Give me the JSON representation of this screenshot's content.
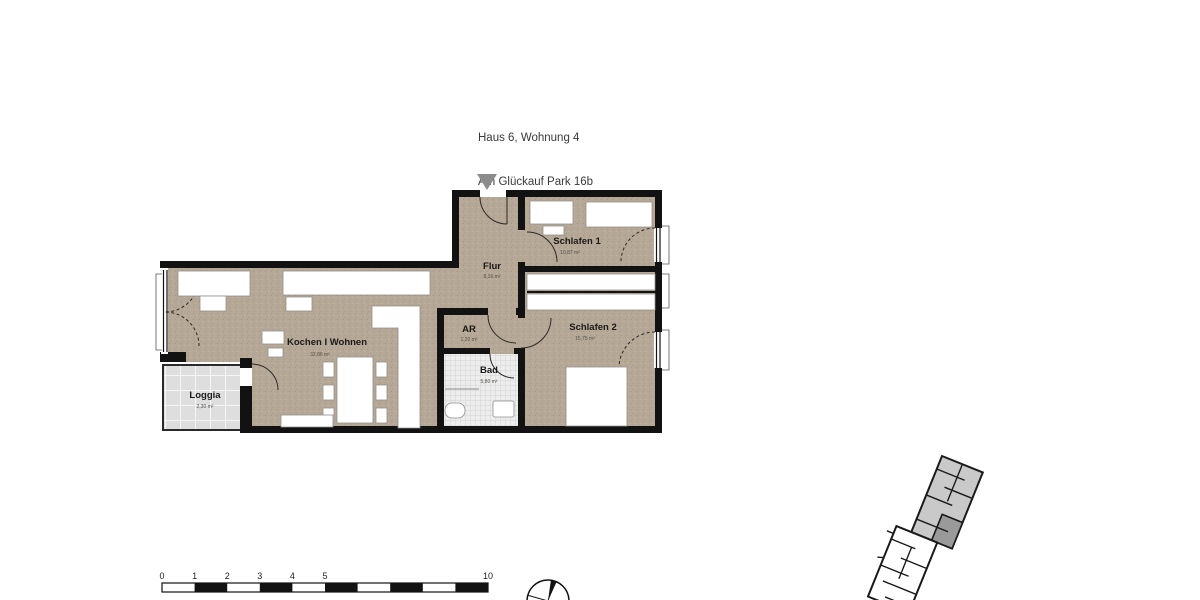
{
  "title": {
    "line1": "Haus 6, Wohnung 4",
    "line2": "Am Glückauf Park 16b",
    "line3": "1. Obergeschoss",
    "line4": "78,71 m²"
  },
  "rooms": {
    "flur": {
      "name": "Flur",
      "area": "8,16 m²"
    },
    "schlafen1": {
      "name": "Schlafen 1",
      "area": "10,87 m²"
    },
    "schlafen2": {
      "name": "Schlafen 2",
      "area": "15,75 m²"
    },
    "ar": {
      "name": "AR",
      "area": "1,20 m²"
    },
    "bad": {
      "name": "Bad",
      "area": "5,80 m²"
    },
    "kochen_wohnen": {
      "name": "Kochen I Wohnen",
      "area": "32,86 m²"
    },
    "loggia": {
      "name": "Loggia",
      "area": "2,30 m²"
    }
  },
  "scalebar": {
    "ticks": [
      "0",
      "1",
      "2",
      "3",
      "4",
      "5",
      "10"
    ]
  },
  "icons": {
    "entrance_marker": "down-triangle",
    "north_symbol": "surveyor-circle-cross",
    "keyplan": "site-key-plan"
  },
  "colors": {
    "floor": "#b5a896",
    "wall": "#121212",
    "bad_tile": "#ededed",
    "loggia_tile": "#e0e0e0",
    "furniture": "#ffffff",
    "entrance_arrow": "#8c8c8c",
    "keyplan_building": "#c9c9c9",
    "keyplan_unit_highlight": "#9a9a9a"
  }
}
